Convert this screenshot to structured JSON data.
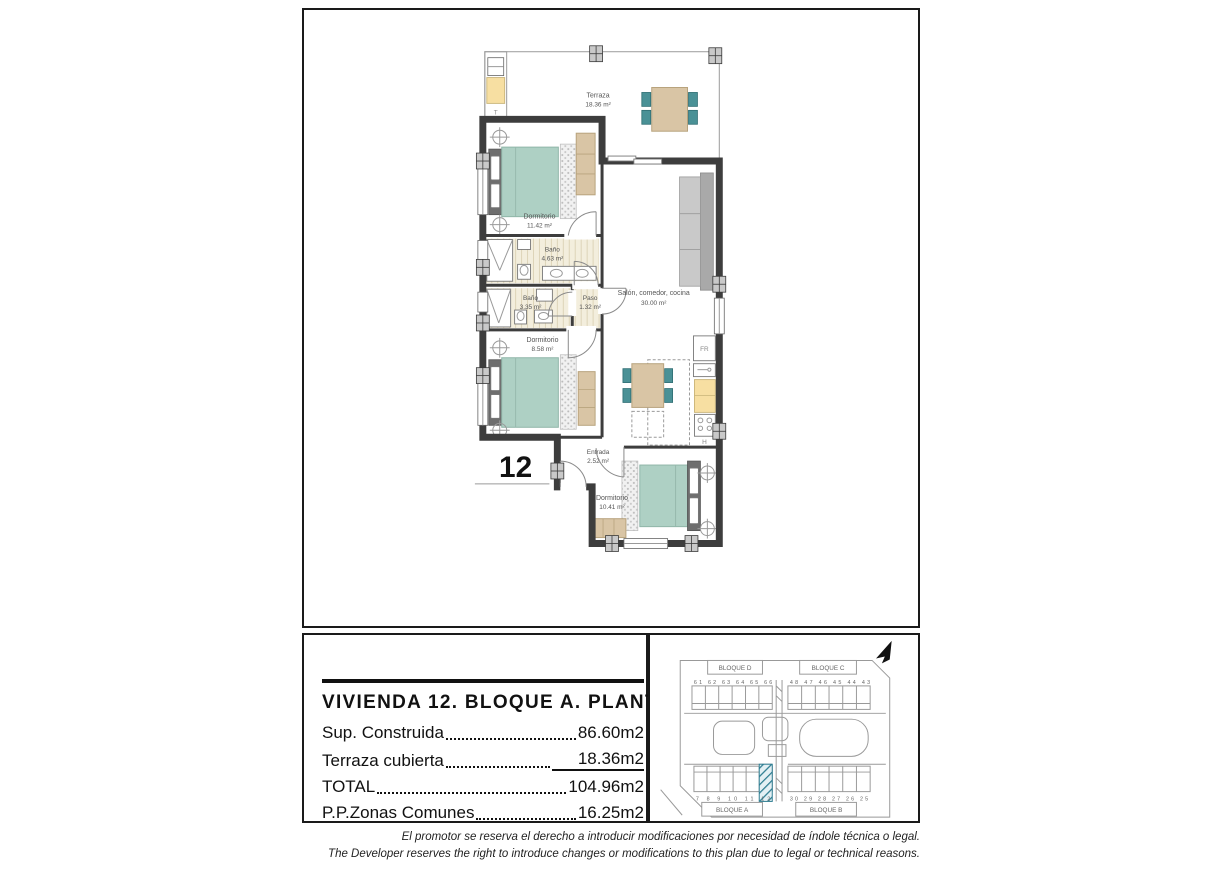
{
  "plan": {
    "unit_number": "12",
    "terrace": {
      "name": "Terraza",
      "area": "18.36 m²",
      "tag": "T"
    },
    "rooms": [
      {
        "name": "Dormitorio",
        "area": "11.42 m²"
      },
      {
        "name": "Baño",
        "area": "4.63 m²"
      },
      {
        "name": "Baño",
        "area": "3.35 m²"
      },
      {
        "name": "Paso",
        "area": "1.32 m²"
      },
      {
        "name": "Dormitorio",
        "area": "8.58 m²"
      },
      {
        "name": "Salón, comedor, cocina",
        "area": "30.00 m²"
      },
      {
        "name": "Entrada",
        "area": "2.52 m²"
      },
      {
        "name": "Dormitorio",
        "area": "10.41 m²"
      }
    ],
    "kitchen": {
      "fridge": "FR",
      "oven": "H"
    }
  },
  "title_block": {
    "title": "VIVIENDA 12. BLOQUE A. PLANTA 1ª",
    "rows": [
      {
        "label": "Sup. Construida",
        "value": "86.60m2"
      },
      {
        "label": "Terraza cubierta",
        "value": "18.36m2"
      },
      {
        "label": "TOTAL",
        "value": "104.96m2"
      },
      {
        "label": "P.P.Zonas Comunes",
        "value": "16.25m2"
      }
    ]
  },
  "site_plan": {
    "blocks": {
      "top_left": "BLOQUE D",
      "top_right": "BLOQUE C",
      "bottom_left": "BLOQUE A",
      "bottom_right": "BLOQUE B"
    },
    "units": {
      "top_left": "61 62 63 64 65 66",
      "top_right": "48 47 46 45 44 43",
      "bottom_left": "7 8 9 10 11 12",
      "bottom_right": "30 29 28 27 26 25"
    },
    "highlighted_unit": "12",
    "highlight_color": "#2e7d91"
  },
  "colors": {
    "accent_teal": "#4a9196",
    "bed_teal": "#aed0c4",
    "furniture_tan": "#d9c5a5",
    "counter_yellow": "#f7dfa2",
    "wall_gray": "#3d3d3d"
  },
  "disclaimer": {
    "es": "El promotor se reserva el derecho a introducir modificaciones por necesidad de índole técnica o legal.",
    "en": "The Developer reserves the right to introduce changes or modifications to this plan due to legal or technical reasons."
  }
}
